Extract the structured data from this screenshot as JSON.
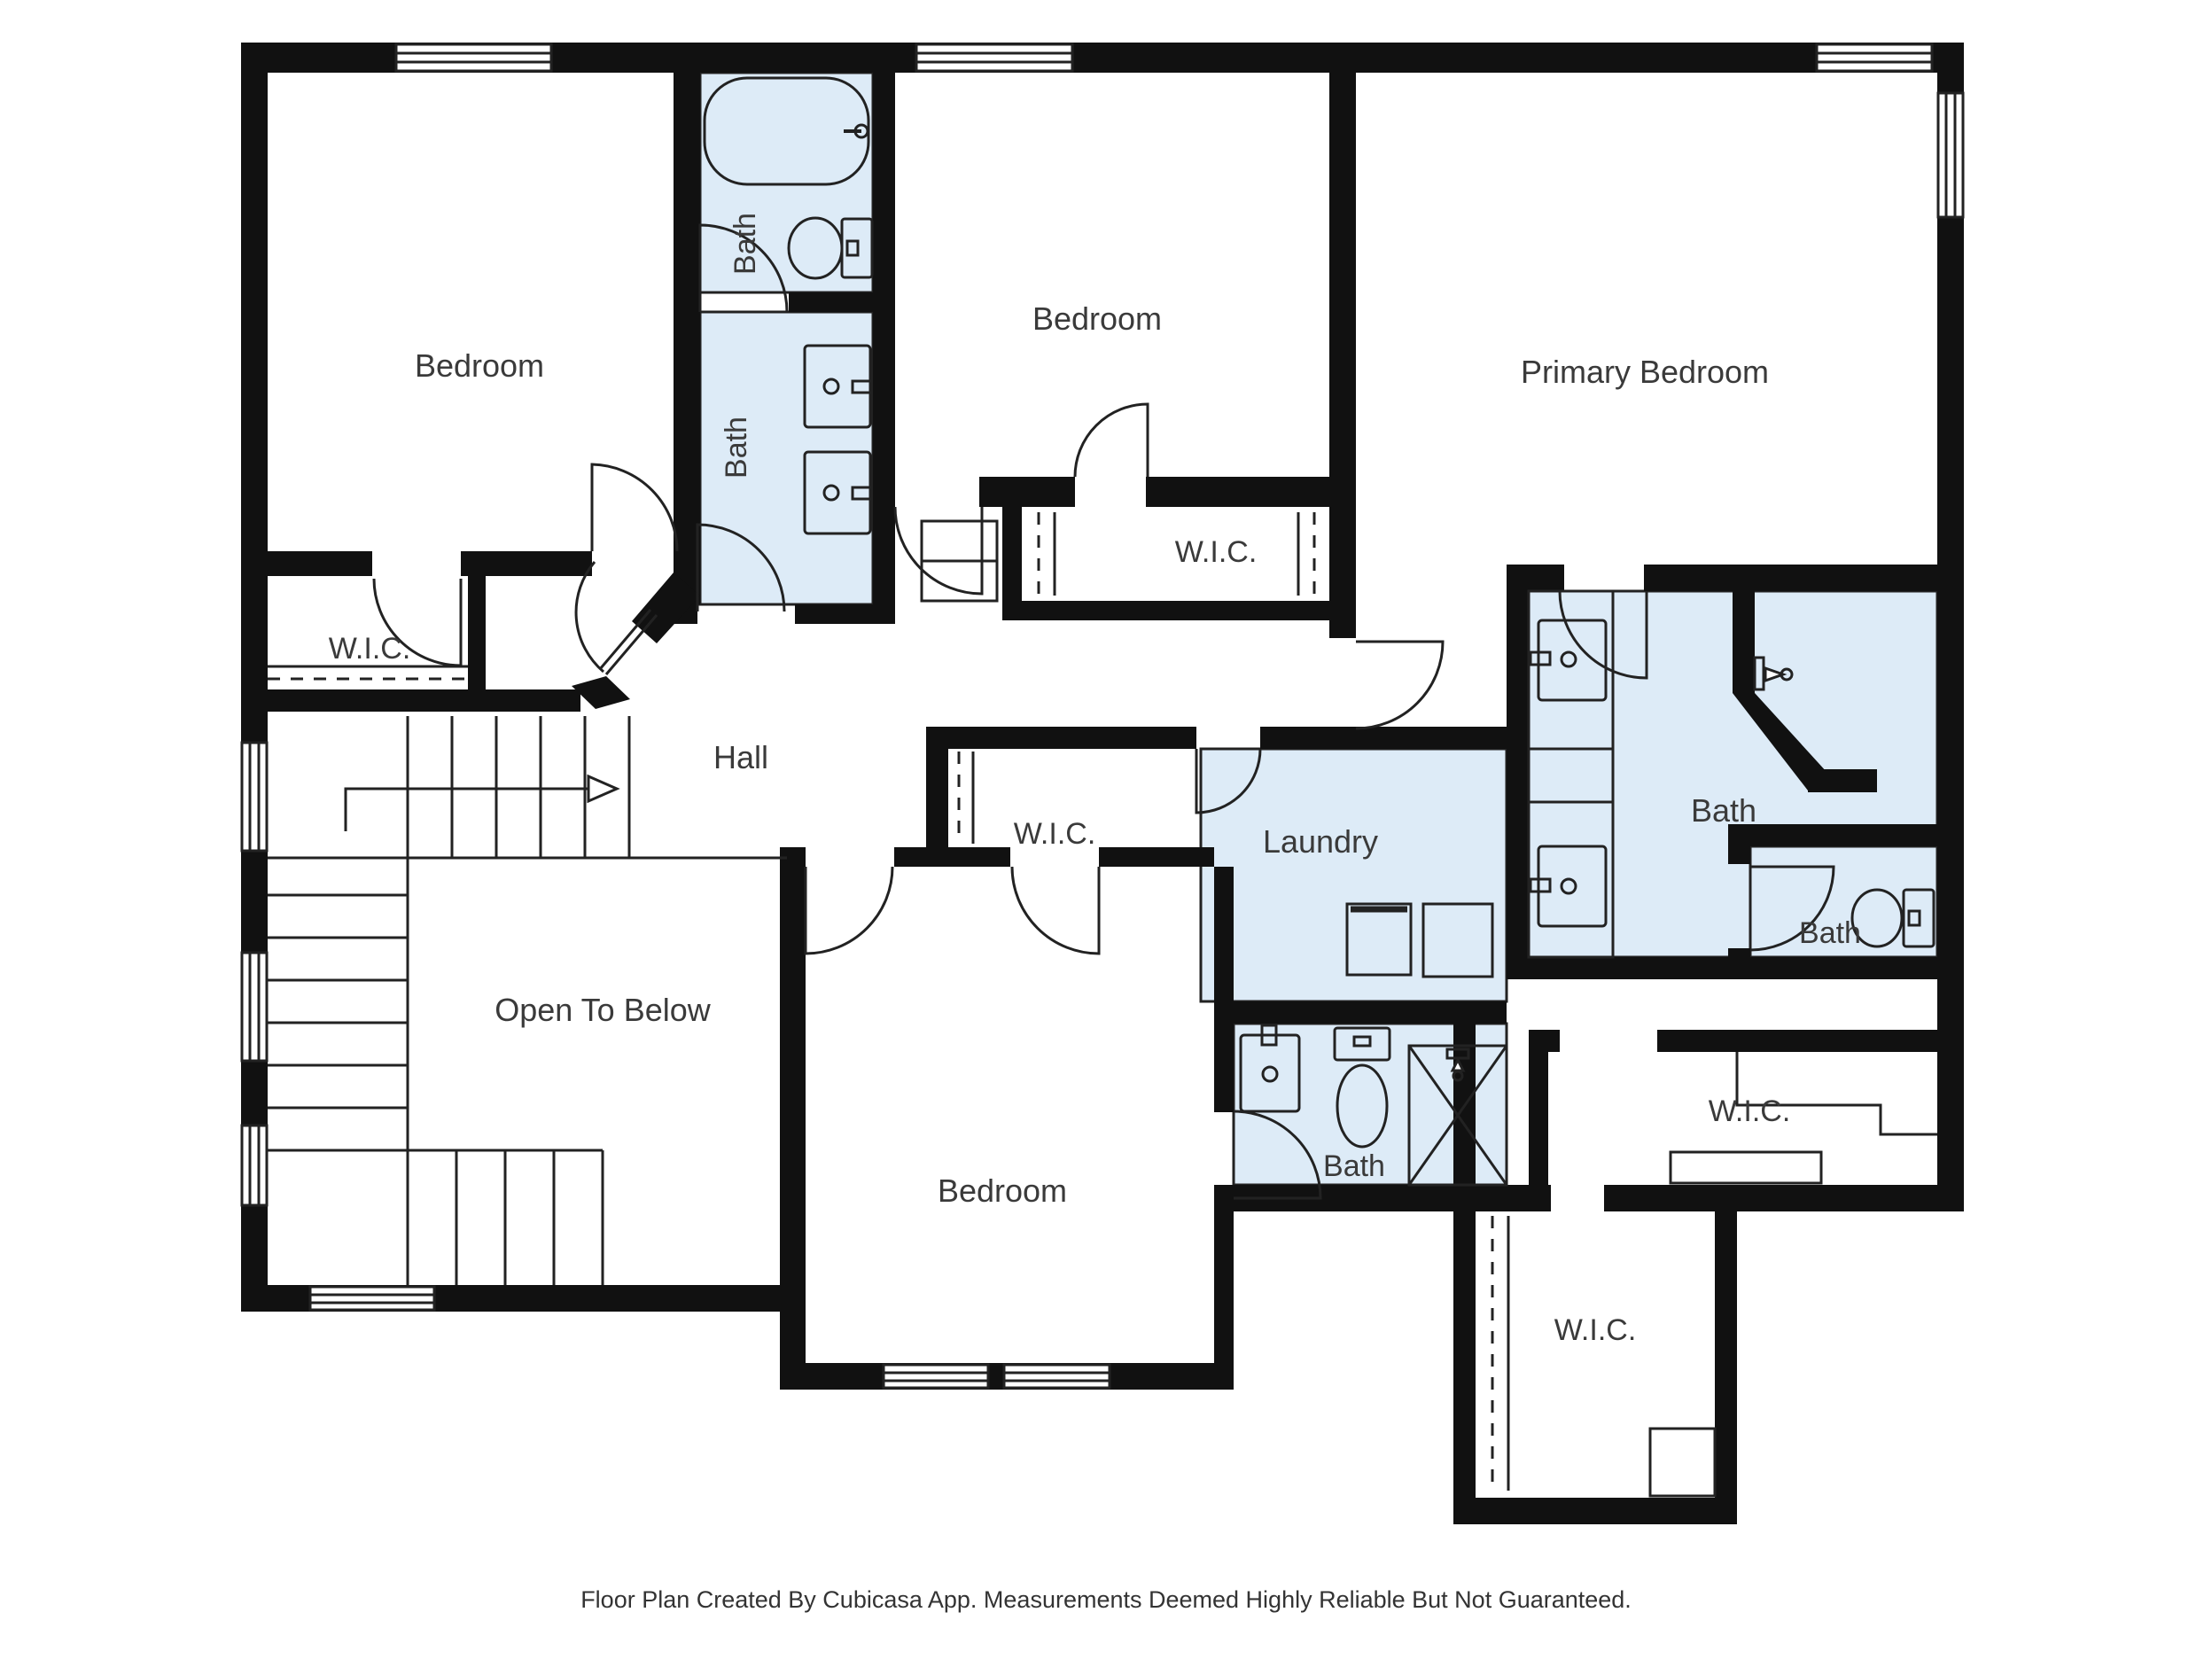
{
  "title": "Second Floor Plan",
  "footer": "Floor Plan Created By Cubicasa App. Measurements Deemed Highly Reliable But Not Guaranteed.",
  "colors": {
    "wall": "#111111",
    "wet_room_fill": "#ddebf7",
    "thin_line": "#222222",
    "label_text": "#3a3a3a",
    "background": "#ffffff"
  },
  "labels": {
    "bedroom_tl": "Bedroom",
    "bath_upper": "Bath",
    "bath_lower": "Bath",
    "bedroom_mid": "Bedroom",
    "primary_bedroom": "Primary Bedroom",
    "wic_tl": "W.I.C.",
    "wic_mid": "W.I.C.",
    "hall": "Hall",
    "laundry": "Laundry",
    "bath_primary": "Bath",
    "bath_small": "Bath",
    "wic_right": "W.I.C.",
    "wic_extension": "W.I.C.",
    "wic_bottom": "W.I.C.",
    "bedroom_bottom": "Bedroom",
    "open_to_below": "Open To Below",
    "bath_ensuite": "Bath"
  },
  "fixtures": [
    "bathtub",
    "toilet-upper-bath",
    "double-vanity-hall-bath",
    "washer",
    "dryer",
    "primary-double-vanity",
    "primary-shower",
    "toilet-primary-wc",
    "ensuite-sink",
    "ensuite-toilet",
    "ensuite-shower",
    "closet-rods-and-shelves",
    "stair-direction-arrow"
  ]
}
